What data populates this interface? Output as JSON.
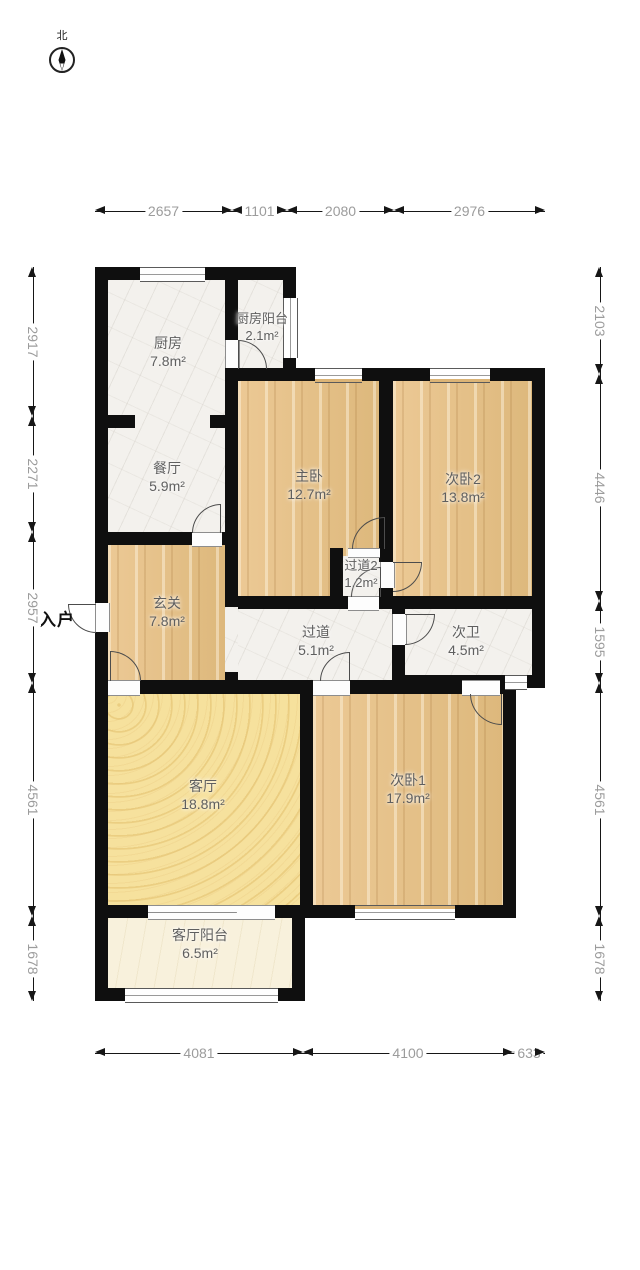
{
  "compass": {
    "label": "北"
  },
  "entry": {
    "label": "入户"
  },
  "rooms": {
    "kitchen": {
      "name": "厨房",
      "area": "7.8m²"
    },
    "kitchen_balcony": {
      "name": "厨房阳台",
      "area": "2.1m²"
    },
    "dining": {
      "name": "餐厅",
      "area": "5.9m²"
    },
    "hallway": {
      "name": "玄关",
      "area": "7.8m²"
    },
    "master": {
      "name": "主卧",
      "area": "12.7m²"
    },
    "bed2": {
      "name": "次卧2",
      "area": "13.8m²"
    },
    "corridor2": {
      "name": "过道2",
      "area": "1.2m²"
    },
    "corridor": {
      "name": "过道",
      "area": "5.1m²"
    },
    "bath": {
      "name": "次卫",
      "area": "4.5m²"
    },
    "living": {
      "name": "客厅",
      "area": "18.8m²"
    },
    "bed1": {
      "name": "次卧1",
      "area": "17.9m²"
    },
    "living_balcony": {
      "name": "客厅阳台",
      "area": "6.5m²"
    }
  },
  "dimensions": {
    "top": [
      "2657",
      "1101",
      "2080",
      "2976"
    ],
    "left": [
      "2917",
      "2271",
      "2957",
      "4561",
      "1678"
    ],
    "right": [
      "2103",
      "4446",
      "1595",
      "4561",
      "1678"
    ],
    "bottom": [
      "4081",
      "4100",
      "633"
    ]
  },
  "colors": {
    "wall": "#0f0f0f",
    "wood_floor": "#e5bf87",
    "marble_floor": "#f3f1ed",
    "living_floor": "#f6e19d",
    "balcony_floor": "#f8f1dc",
    "dimension_text": "#9c9c9c",
    "label_text": "#5f5f5f"
  }
}
